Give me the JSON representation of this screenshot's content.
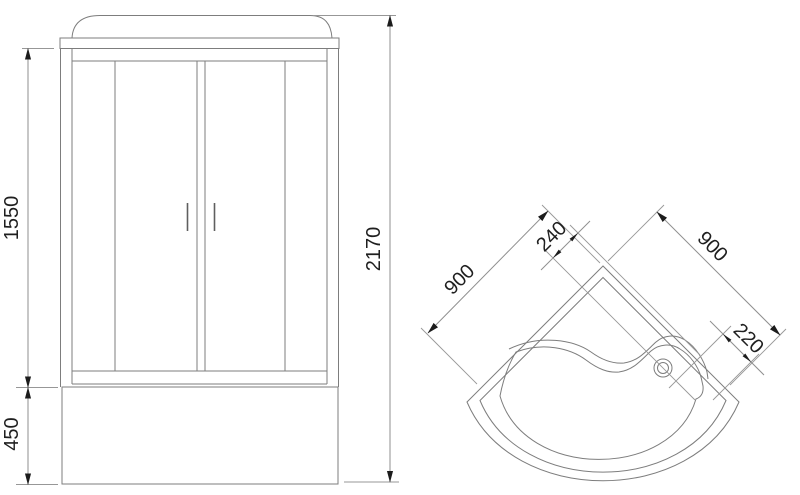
{
  "title": "Shower cabin technical drawing",
  "views": {
    "front": {
      "label": "front view",
      "dims": {
        "door_height": "1550",
        "tray_height": "450",
        "total_height": "2170"
      }
    },
    "top": {
      "label": "top view",
      "dims": {
        "left_side": "900",
        "drain_offset": "240",
        "right_side": "900",
        "corner_offset": "220"
      }
    }
  },
  "colors": {
    "background": "#ffffff",
    "outline": "#7d7d7d",
    "dimension_line": "#8f8f8f",
    "arrow": "#1c1c1c",
    "text": "#1f1f1f"
  }
}
